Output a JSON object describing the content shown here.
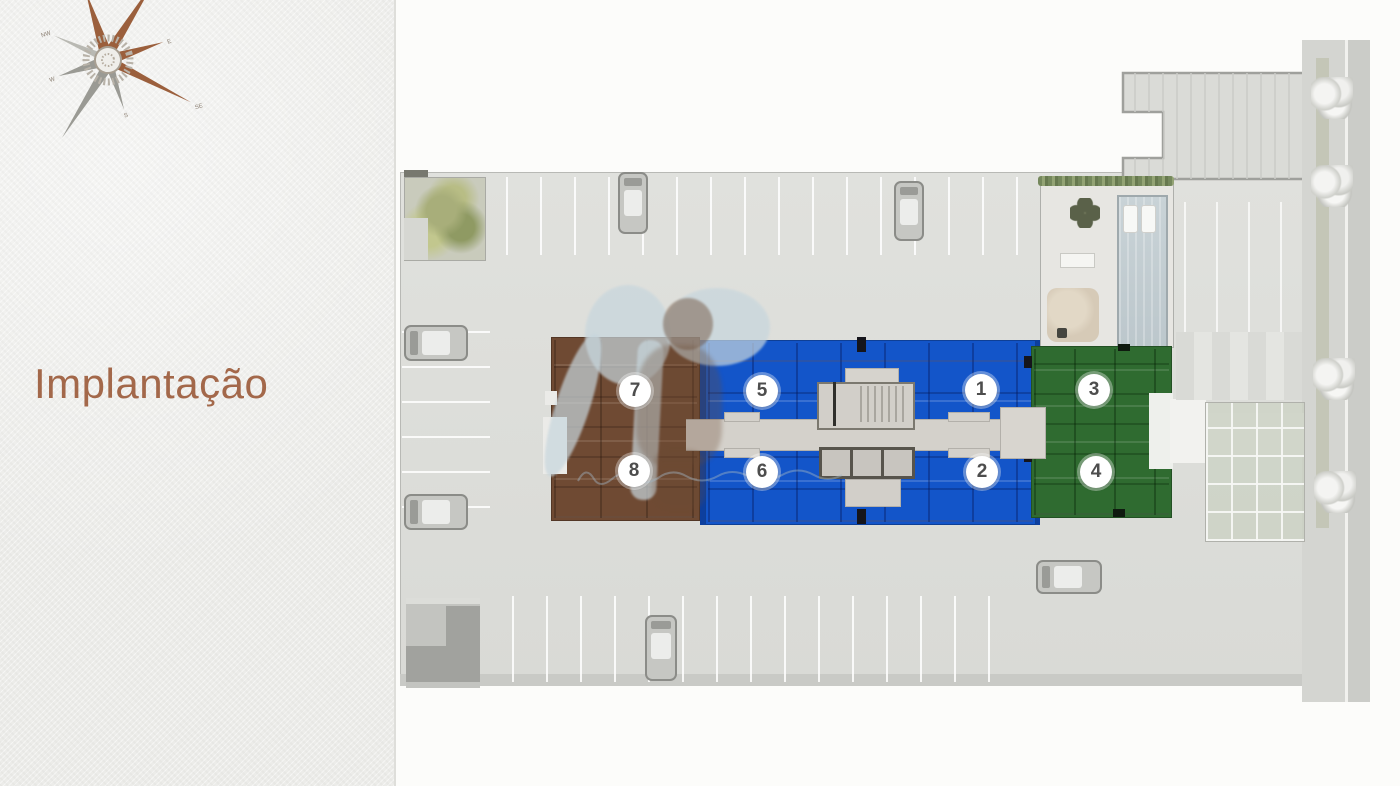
{
  "header": {
    "title": "Implantação",
    "title_color": "#a3684a"
  },
  "compass": {
    "labels": {
      "n": "N",
      "ne": "NE",
      "e": "E",
      "se": "SE",
      "s": "S",
      "sw": "SW",
      "w": "W",
      "nw": "NW"
    }
  },
  "plan": {
    "units": [
      {
        "number": "1",
        "wing": "center-blue",
        "color": "#1355c9"
      },
      {
        "number": "2",
        "wing": "center-blue",
        "color": "#1355c9"
      },
      {
        "number": "3",
        "wing": "right-green",
        "color": "#2f6b30"
      },
      {
        "number": "4",
        "wing": "right-green",
        "color": "#2f6b30"
      },
      {
        "number": "5",
        "wing": "center-blue",
        "color": "#1355c9"
      },
      {
        "number": "6",
        "wing": "center-blue",
        "color": "#1355c9"
      },
      {
        "number": "7",
        "wing": "left-brown",
        "color": "#6f4a33"
      },
      {
        "number": "8",
        "wing": "left-brown",
        "color": "#6f4a33"
      }
    ],
    "colors": {
      "wing_blue": "#1355c9",
      "wing_green": "#2f6b30",
      "wing_brown": "#6f4a33",
      "parking_gray": "#dcddd9",
      "accent_copper": "#a3684a",
      "watermark_blue": "#c7d6dd"
    }
  }
}
